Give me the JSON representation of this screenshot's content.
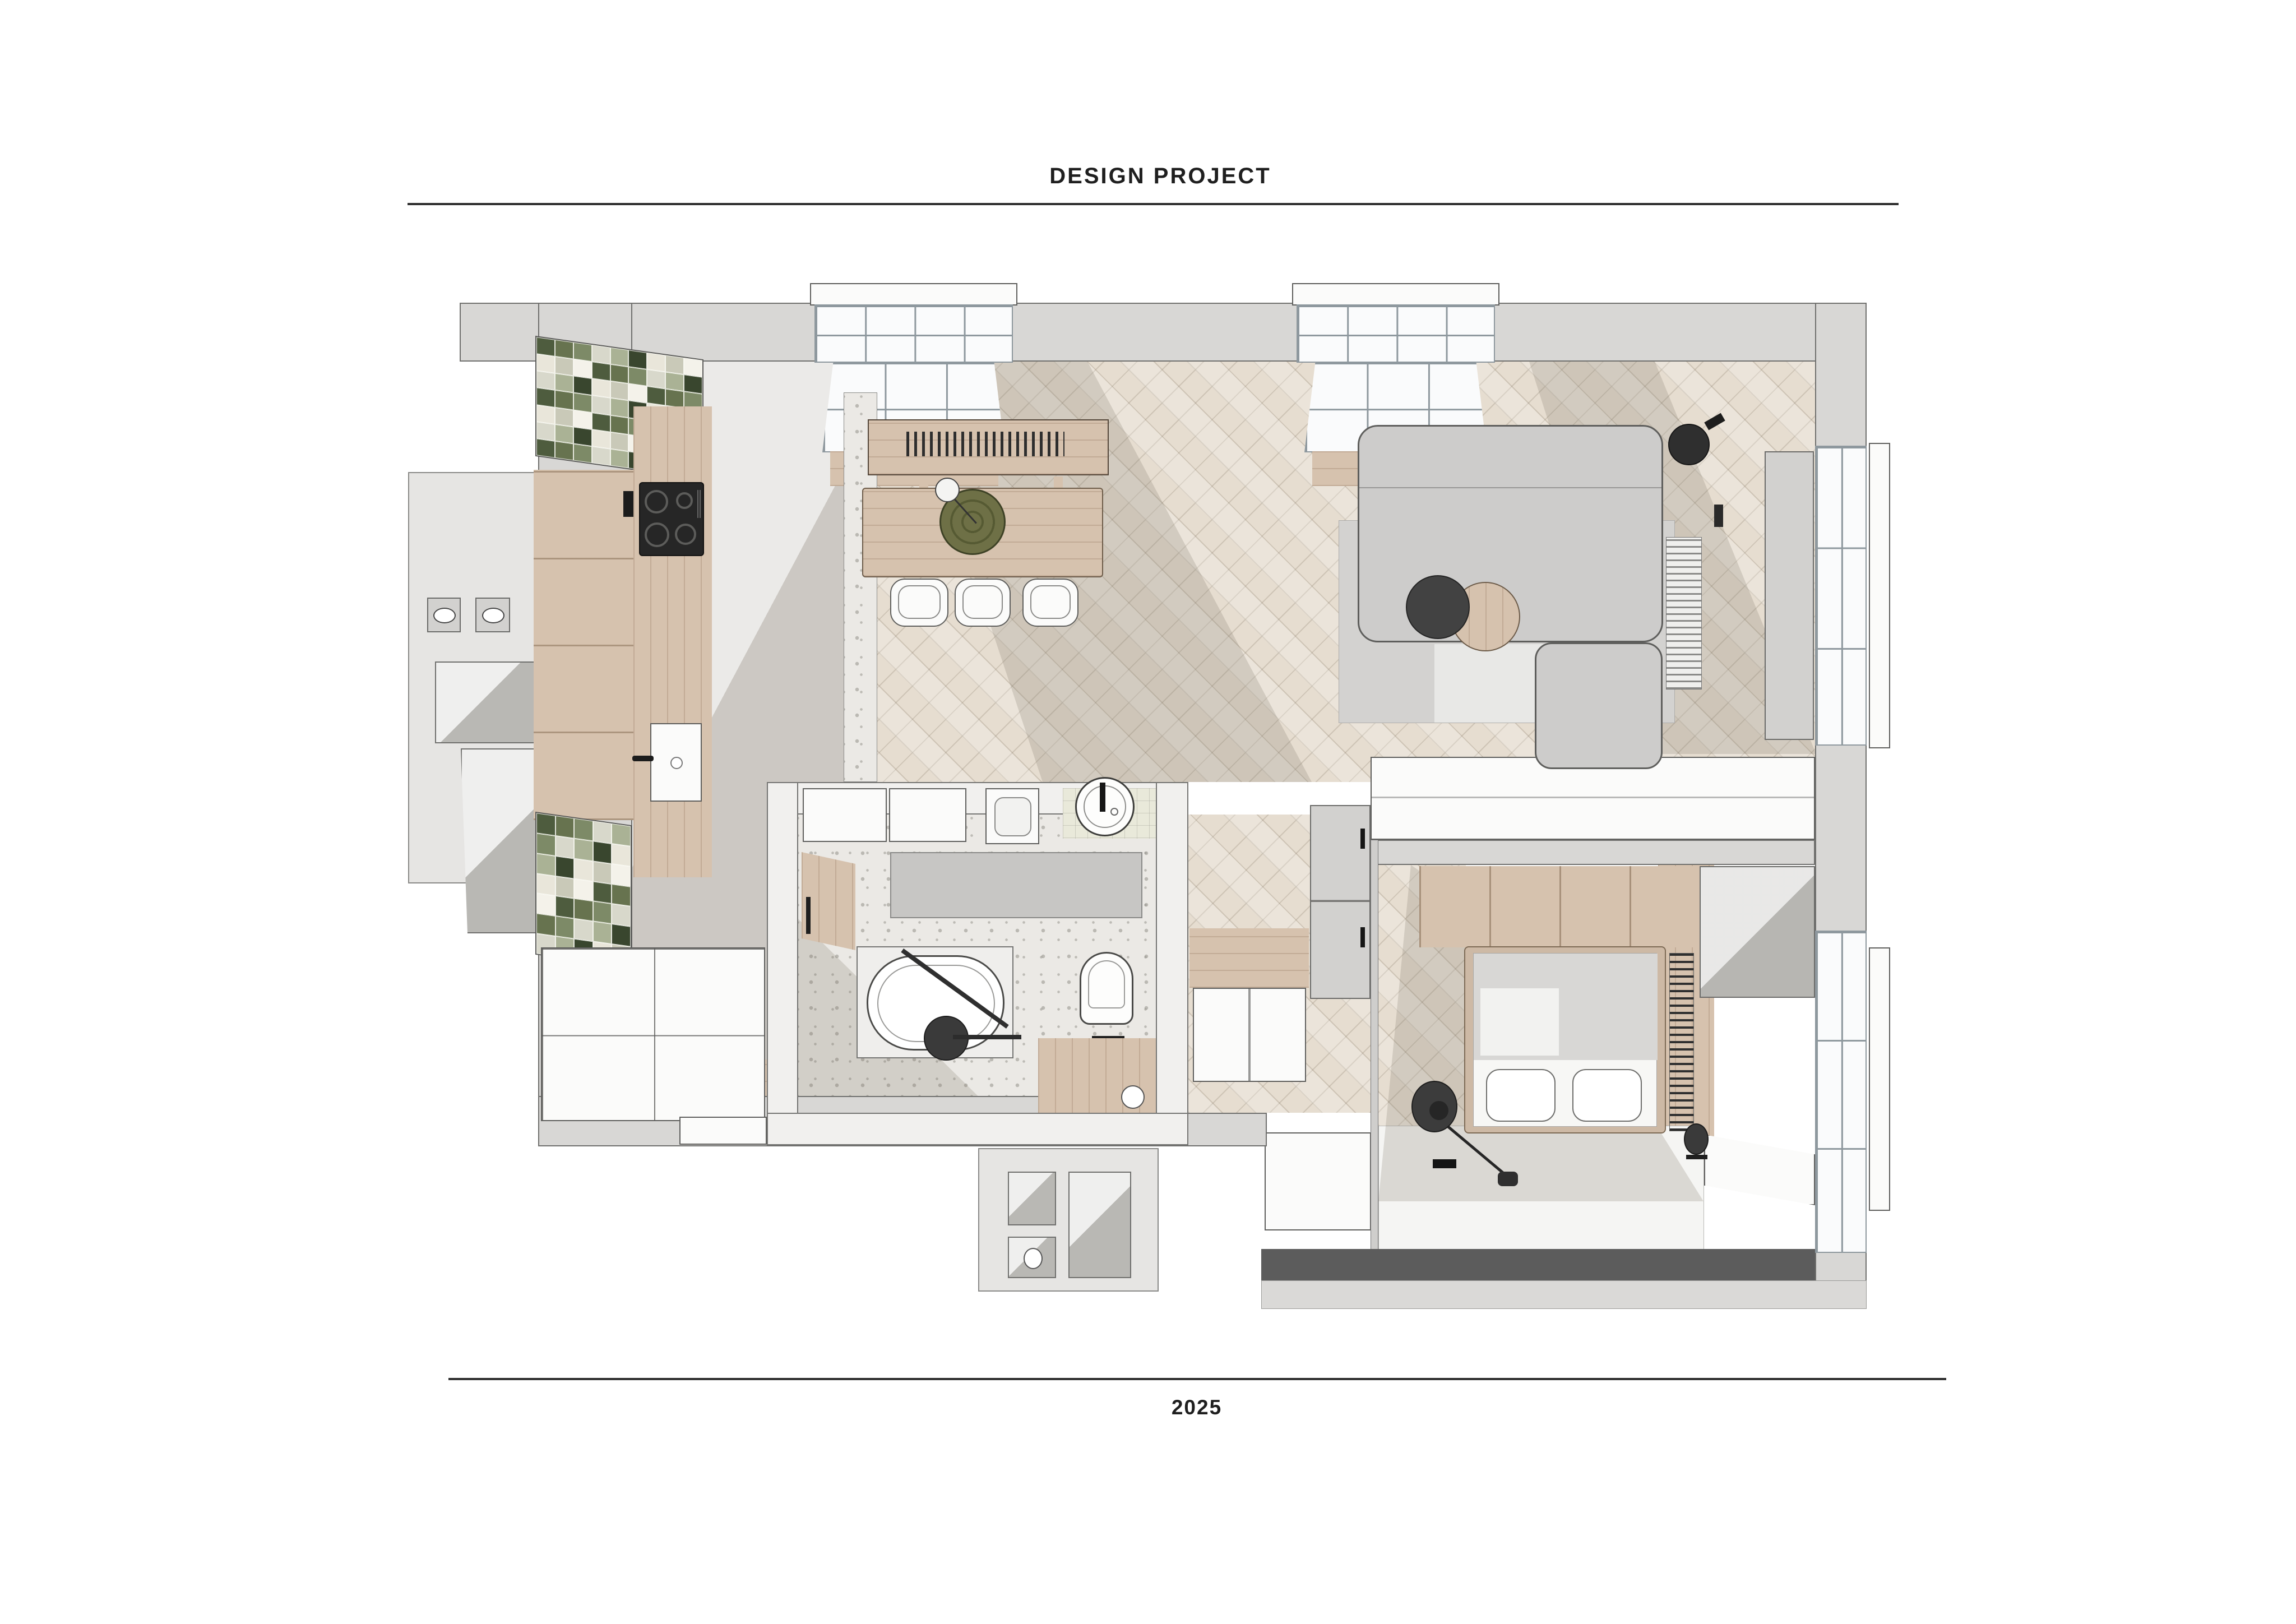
{
  "header": {
    "title": "DESIGN PROJECT"
  },
  "footer": {
    "year": "2025"
  },
  "palette": {
    "background": "#ffffff",
    "ink": "#1f1f1f",
    "wall": "#d8d7d5",
    "wall_line": "#70706e",
    "exterior": "#e6e5e3",
    "floor_herringbone": "#e6ddd0",
    "floor_plain": "#dedcd8",
    "terrazzo": "#ebe9e5",
    "wood": "#d6c2ae",
    "white_furniture": "#fbfbfa",
    "sofa": "#cdcccb",
    "rug": "#d3d2d0",
    "accent_dark": "#3a3a3a",
    "window_strip_dark": "#5c5c5c",
    "rug_green": "#6e7046",
    "mosaic_tiles": [
      "#4e5c3e",
      "#7d8a67",
      "#aab295",
      "#e9e6da",
      "#f4f2ea",
      "#67734f",
      "#d8d8cb",
      "#39462e",
      "#c9c9b8"
    ]
  }
}
